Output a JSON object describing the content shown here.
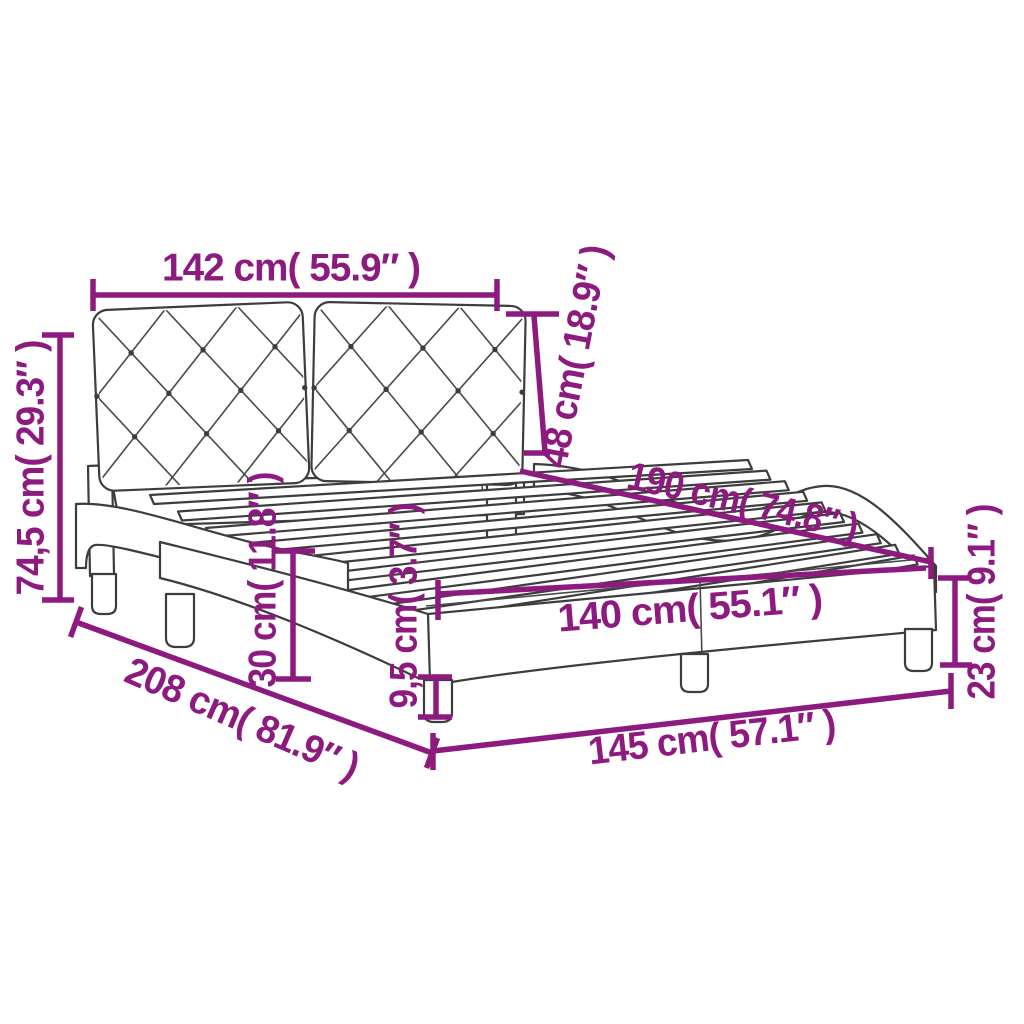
{
  "figure": {
    "type": "product dimension diagram",
    "subject": "bed frame with tufted headboard and slatted base"
  },
  "style": {
    "accent_color": "#8D1A7E",
    "line_color": "#3d3d3d",
    "background": "#ffffff"
  },
  "dims": {
    "headboard_width": "142 cm( 55.9″ )",
    "headboard_height": "48 cm( 18.9″ )",
    "total_height": "74,5 cm( 29.3″ )",
    "bed_length": "190 cm( 74.8″ )",
    "rail_height": "30 cm( 11.8″ )",
    "front_leg_height": "9,5 cm( 3.7″ )",
    "slat_area_width": "140 cm( 55.1″ )",
    "total_length": "208 cm( 81.9″ )",
    "frame_width": "145 cm( 57.1″ )",
    "base_height": "23 cm( 9.1″ )"
  }
}
